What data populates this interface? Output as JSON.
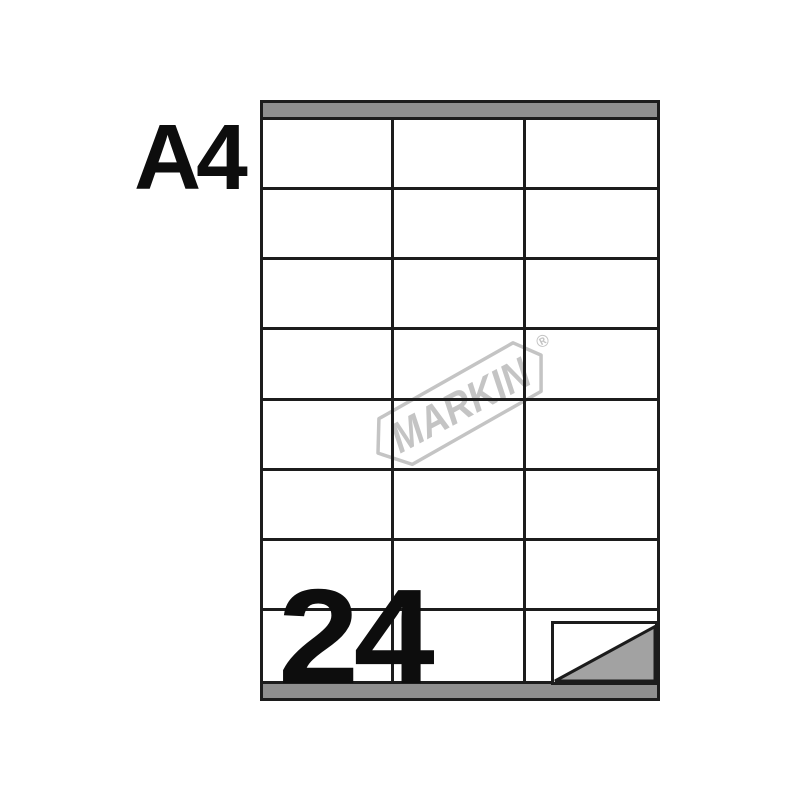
{
  "product": {
    "paper_format": "A4",
    "labels_count": "24",
    "brand_name": "MARKIN",
    "registered_mark": "®"
  },
  "sheet": {
    "rows": 8,
    "columns": 3,
    "total_labels": 24
  },
  "colors": {
    "background": "#ffffff",
    "line": "#1c1c1c",
    "header_bar": "#8f8f8f",
    "peel_triangle": "#a2a2a2",
    "logo": "#c4c4c4",
    "text": "#0d0d0d"
  }
}
